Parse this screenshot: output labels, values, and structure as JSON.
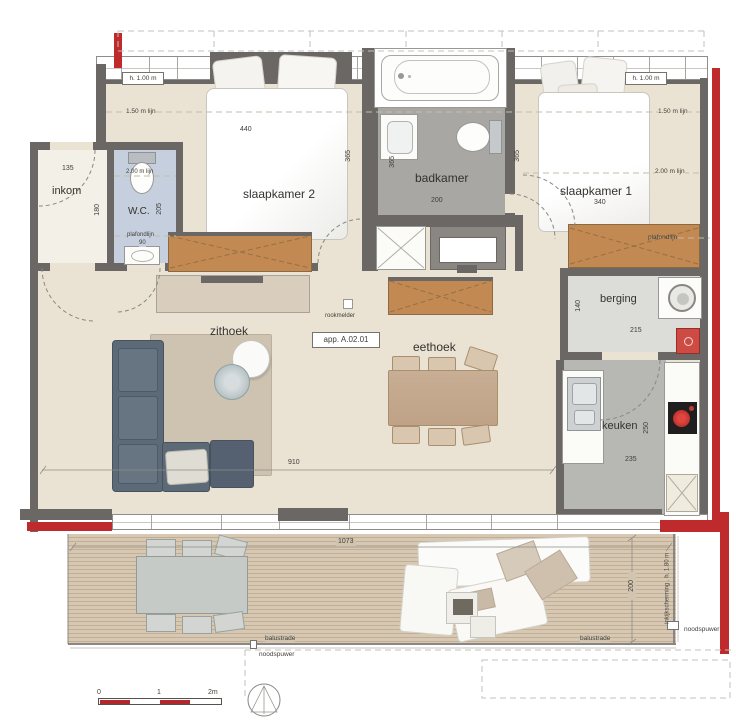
{
  "floorplan": {
    "apartment_label": "app. A.02.01",
    "rooms": {
      "inkom": "inkom",
      "wc": "W.C.",
      "slaapkamer2": "slaapkamer 2",
      "badkamer": "badkamer",
      "slaapkamer1": "slaapkamer 1",
      "zithoek": "zithoek",
      "eethoek": "eethoek",
      "berging": "berging",
      "keuken": "keuken"
    },
    "dimensions": {
      "inkom_w": "135",
      "inkom_d": "180",
      "wc_d": "205",
      "wc_plafond": "90",
      "slaapkamer2_w": "440",
      "slaapkamer2_door": "365",
      "badkamer_d": "365",
      "badkamer_w": "200",
      "badkamer_d2": "365",
      "slaapkamer1_w": "340",
      "berging_d": "140",
      "berging_w": "215",
      "keuken_d": "250",
      "keuken_w": "235",
      "living_w": "910",
      "terras_w": "1073",
      "terras_d": "200"
    },
    "annotations": {
      "rookmelder": "rookmelder",
      "h100_left": "h. 1.00 m",
      "h100_right": "h. 1.00 m",
      "lijn150_left": "1.50 m lijn",
      "lijn150_right": "1.50 m lijn",
      "lijn200_wc": "2.00 m lijn",
      "lijn200_right": "2.00 m lijn",
      "plafondlijn_wc": "plafondlijn",
      "plafondlijn_right": "plafondlijn",
      "balustrade_left": "balustrade",
      "balustrade_right": "balustrade",
      "noodspuwer_bottom": "noodspuwer",
      "noodspuwer_right": "noodspuwer",
      "scherm": "inkijkscherming . h. 1.80 m"
    },
    "scalebar": {
      "zero": "0",
      "one": "1",
      "two": "2m"
    },
    "colors": {
      "wall": "#6b6764",
      "accent_red": "#bf2a2c",
      "floor": "#eae3d4",
      "wc_floor": "#c6cfdd",
      "bath_floor": "#a8a7a3",
      "deck": "#d5c7b2"
    }
  }
}
